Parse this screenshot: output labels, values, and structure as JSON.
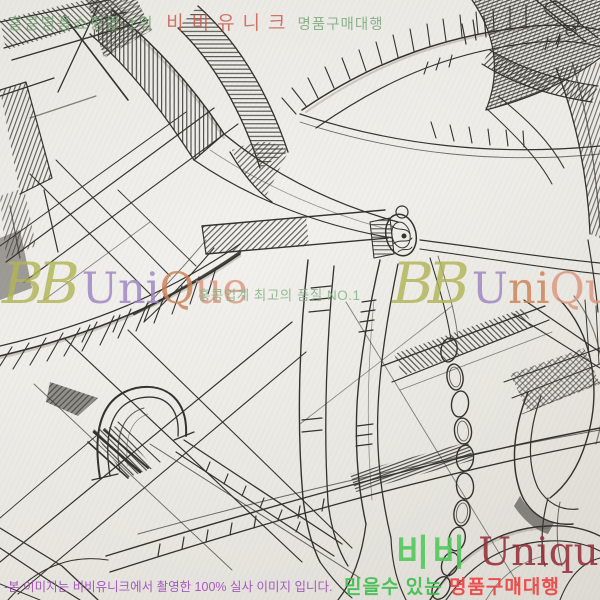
{
  "banner": {
    "rank": "홍콩명품쇼핑몰 1위",
    "brand": "비비유니크",
    "service": "명품구매대행"
  },
  "watermark_left": {
    "script": "BB",
    "seg_purple": "Uni",
    "seg_orange": "Q",
    "seg_salmon": "ue"
  },
  "watermark_right": {
    "script": "BB",
    "seg_purple": "U",
    "seg_orange": "ni",
    "seg_salmon": "Que"
  },
  "tagline": "홍콩업계 최고의 품질 NO.1",
  "logo": {
    "korean": "비비",
    "latin": "Unique"
  },
  "slogan": {
    "lead": "믿을수 있는",
    "tail": " 명품구매대행"
  },
  "disclaimer": "-본 이미지는 비비유니크에서 촬영한 100% 실사 이미지 입니다.",
  "theme": {
    "paper": "#eae8e2",
    "ink": "#35332e",
    "banner-green": "#74a476",
    "banner-red": "#c8584a",
    "wm-olive": "#b2b656",
    "wm-purple": "#9d85c3",
    "wm-orange": "#cd8255",
    "wm-salmon": "#de977f",
    "tag-green": "#85b187",
    "logo-green": "#50c95b",
    "logo-maroon": "#96303a",
    "slogan-green": "#3fbf4e",
    "slogan-red": "#ee4140",
    "disc-purple": "#a24fba"
  }
}
